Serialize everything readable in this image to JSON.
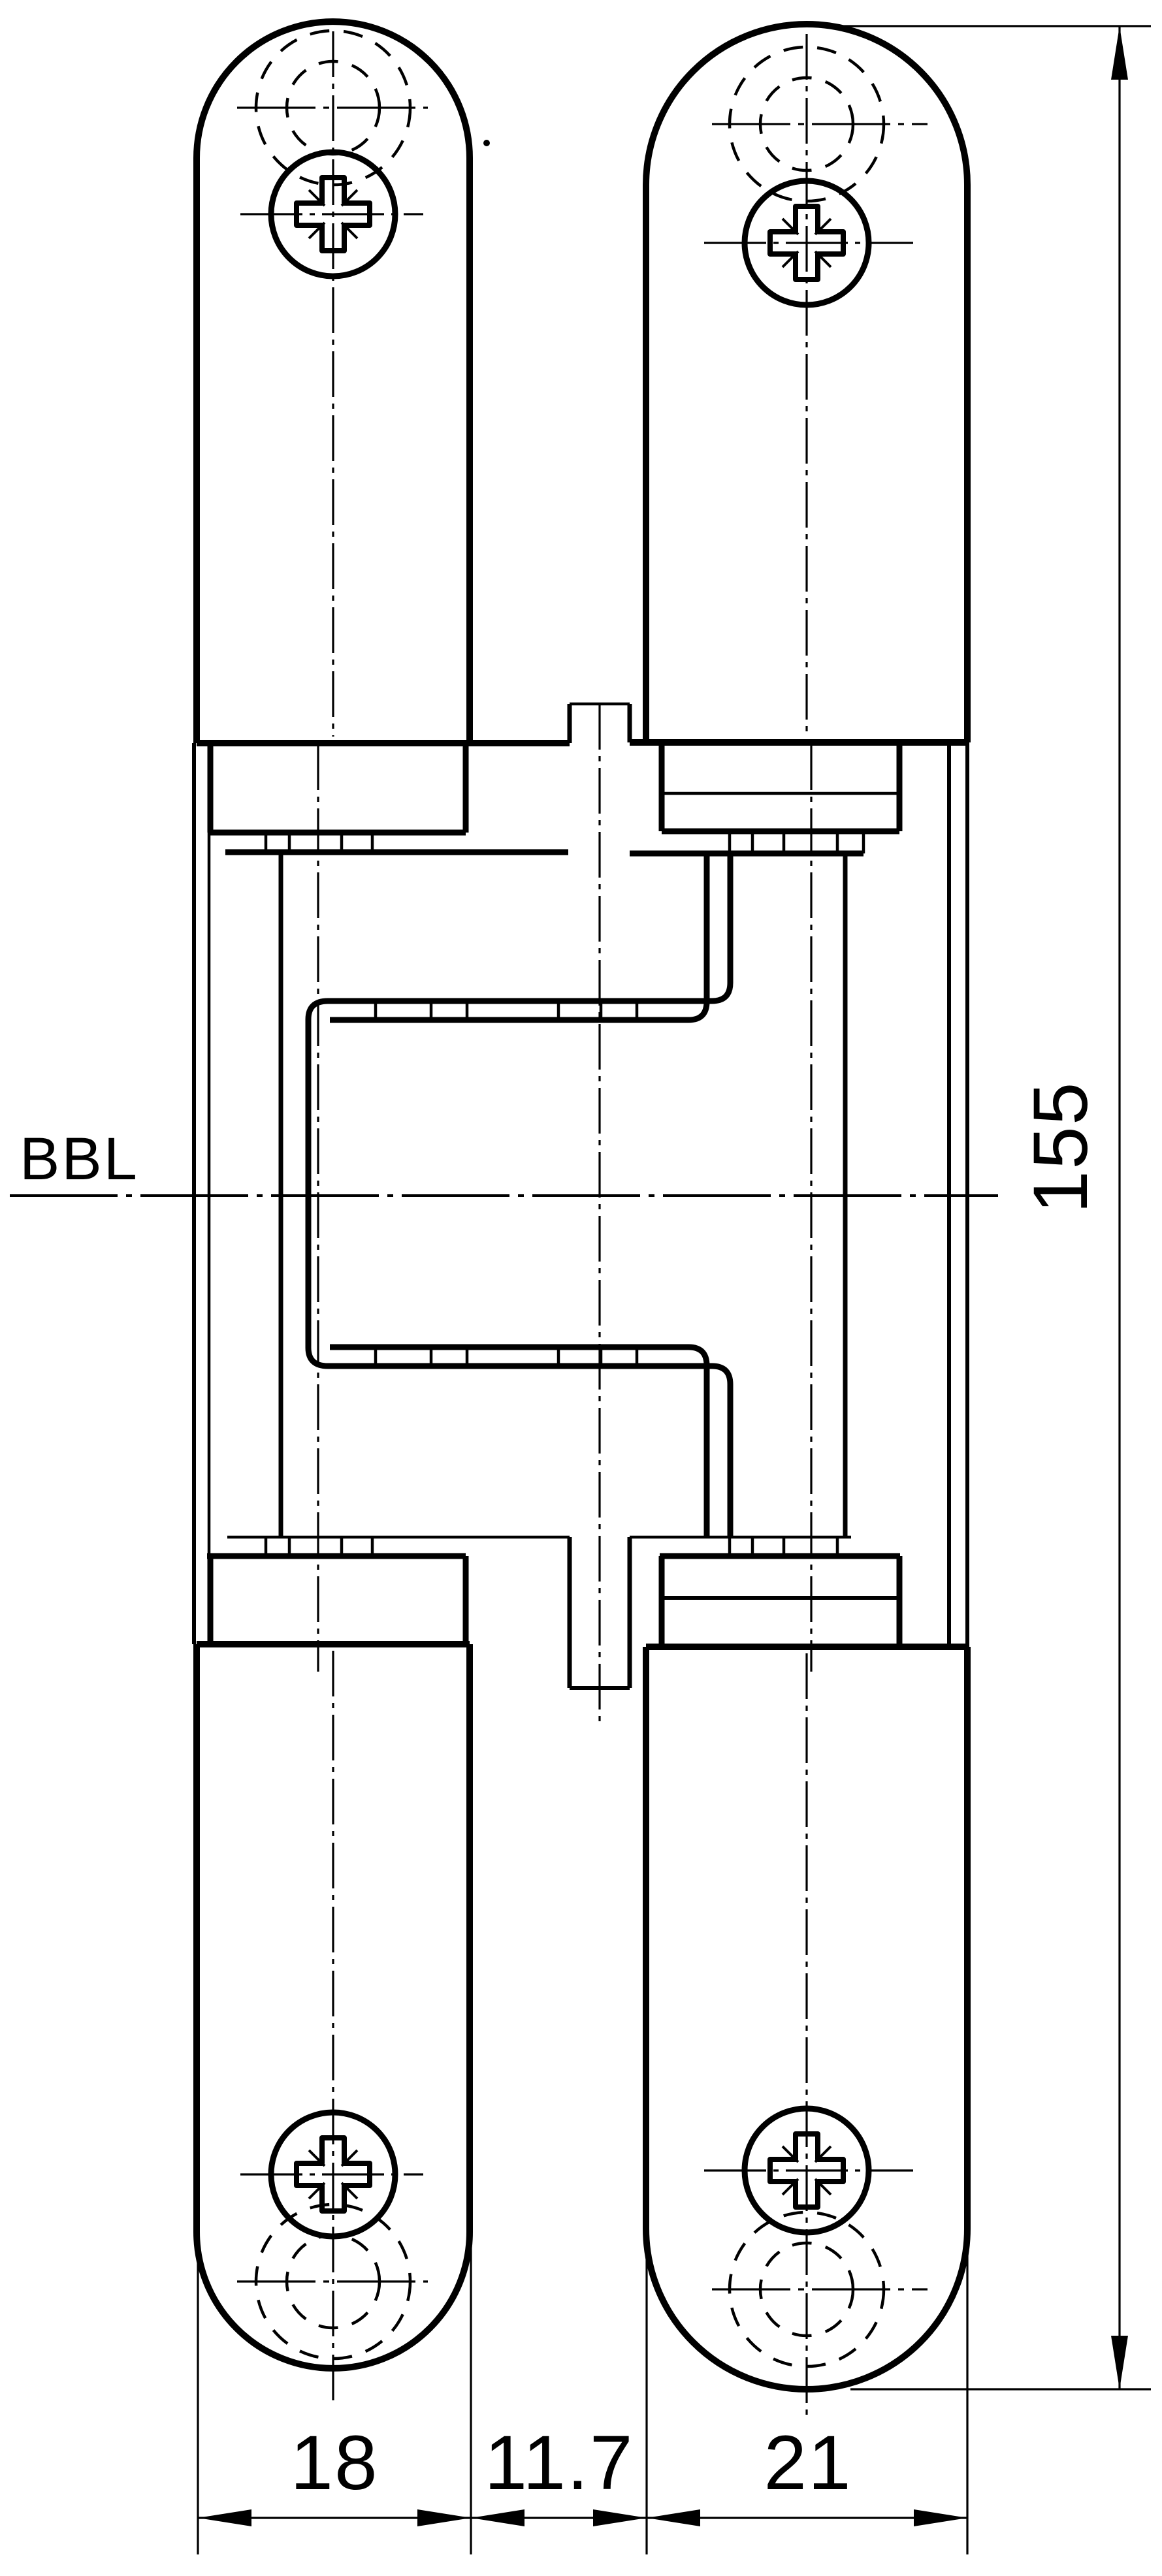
{
  "drawing": {
    "type": "technical-drawing",
    "subject": "concealed-hinge-front-view",
    "background_color": "#ffffff",
    "line_color": "#000000",
    "labels": {
      "reference_line": "BBL",
      "height_dim": "155",
      "width_left": "18",
      "width_gap": "11.7",
      "width_right": "21"
    },
    "icons": [
      "pozidriv-screw-icon",
      "hidden-drill-hole-dashed-circles",
      "center-axis-line",
      "dimension-arrow"
    ],
    "dimensions_mm": {
      "leaf_left_width": 18,
      "gap_width": 11.7,
      "leaf_right_width": 21,
      "leaf_height": 155
    }
  }
}
